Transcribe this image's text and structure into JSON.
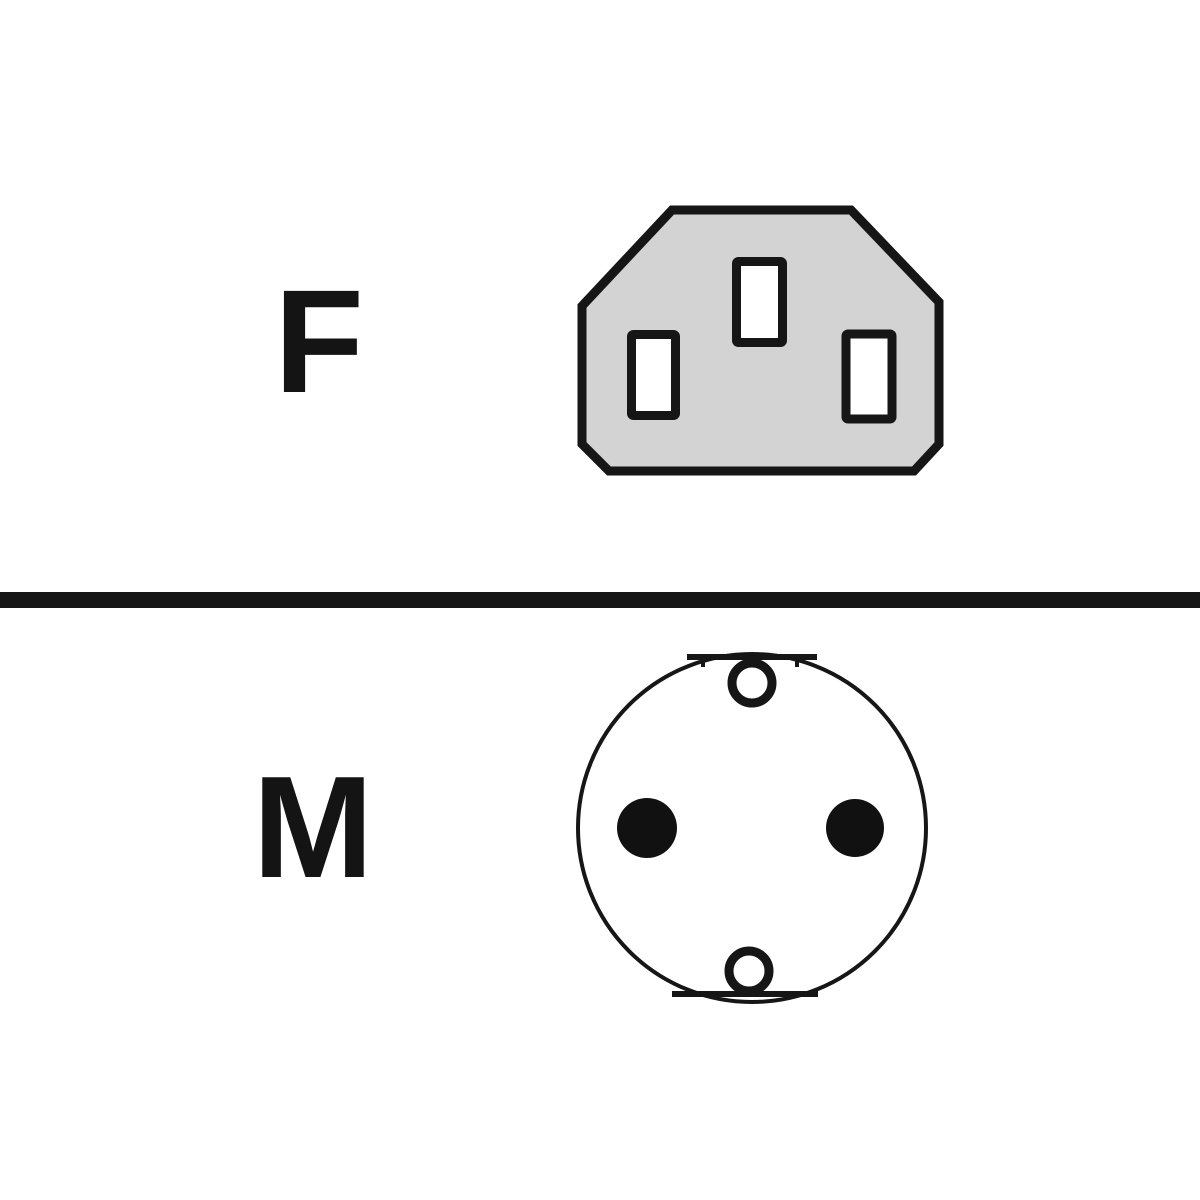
{
  "diagram": {
    "name": "power-cable-connector-ends",
    "sections": [
      {
        "label": "F",
        "meaning": "female connector end",
        "icon": "c13-female-connector-icon"
      },
      {
        "label": "M",
        "meaning": "male connector end",
        "icon": "schuko-male-connector-icon"
      }
    ]
  },
  "icons": {
    "c13-female-connector-icon": "gray octagonal IEC C13 socket face with three rectangular pin slots",
    "schuko-male-connector-icon": "round plug face with two solid round pins and earth-clip holes at top and bottom"
  },
  "colors": {
    "background": "#ffffff",
    "outline": "#161616",
    "connector_body_fill": "#d3d3d3",
    "slot_fill": "#ffffff",
    "pin_fill": "#111111"
  }
}
